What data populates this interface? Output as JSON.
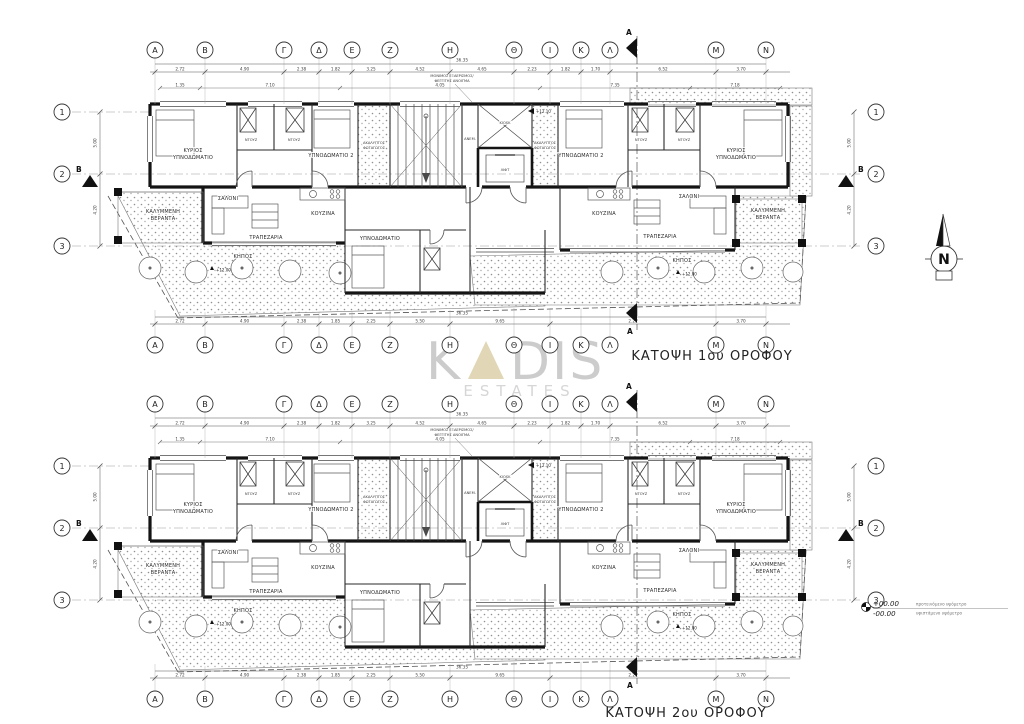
{
  "grid": {
    "columns": [
      "A",
      "B",
      "Γ",
      "Δ",
      "E",
      "Z",
      "H",
      "Θ",
      "I",
      "K",
      "Λ",
      "M",
      "N"
    ],
    "rows": [
      "1",
      "2",
      "3"
    ]
  },
  "section_markers": {
    "a": "A",
    "b": "B"
  },
  "dimensions": {
    "overall": "36.35",
    "top": [
      "2.72",
      "4.90",
      "2.38",
      "1.82",
      "3.25",
      "4.52",
      "4.65",
      "2.23",
      "1.82",
      "1.70",
      "6.52",
      "3.70"
    ],
    "upper_inner": [
      "1.35",
      "7.10",
      "4.05",
      "7.35",
      "7.18"
    ],
    "bottom": [
      "2.72",
      "4.90",
      "2.38",
      "1.85",
      "2.25",
      "5.50",
      "9.65",
      "2.21",
      "3.70"
    ],
    "side": [
      "5.00",
      "4.20"
    ]
  },
  "rooms": {
    "master_line1": "ΚΥΡΙΟΣ",
    "master_line2": "ΥΠΝΟΔΩΜΑΤΙΟ",
    "bedroom2": "ΥΠΝΟΔΩΜΑΤΙΟ 2",
    "bedroom": "ΥΠΝΟΔΩΜΑΤΙΟ",
    "shower": "ΝΤΟΥΖ",
    "living": "ΣΑΛΟΝΙ",
    "dining": "ΤΡΑΠΕΖΑΡΙΑ",
    "kitchen": "ΚΟΥΖΙΝΑ",
    "covered_line1": "ΚΑΛΥΜΜΕΝΗ",
    "covered_line2": "ΒΕΡΑΝΤΑ",
    "garden": "ΚΗΠΟΣ",
    "lift": "ΛΙΦΤ",
    "kiosk": "KIOSK",
    "stair_note": "ΑΝΕΜ.",
    "lightwell_line1": "ΑΚΑΛΥΠΤΟΣ",
    "lightwell_line2": "ΦΩΤΑΓΩΓΟΣ"
  },
  "levels": {
    "floor": "+12.10",
    "garden": "+12.00"
  },
  "vent_note_line1": "ΜΟΝΙΜΟΣ ΕΞΑΕΡΙΣΜΟΣ/",
  "vent_note_line2": "ΦΕΓΓΙΤΗΣ ΑΝΟΙΓΜΑ",
  "plans": [
    {
      "title": "ΚΑΤΟΨΗ 1ου ΟΡΟΦΟΥ"
    },
    {
      "title": "ΚΑΤΟΨΗ 2ου ΟΡΟΦΟΥ"
    }
  ],
  "watermark": {
    "prefix": "K",
    "suffix": "DIS",
    "line2": "ESTATES"
  },
  "compass": {
    "label": "N"
  },
  "elevation_key": {
    "proposed_value": "+00.00",
    "proposed_label": "προτεινόμενο υψόμετρο",
    "existing_value": "-00.00",
    "existing_label": "υφιστάμενο υψόμετρο"
  },
  "colors": {
    "watermark_gray": "#c7c7c7",
    "watermark_beige": "#ded2ae",
    "ink": "#1c1c1c"
  }
}
